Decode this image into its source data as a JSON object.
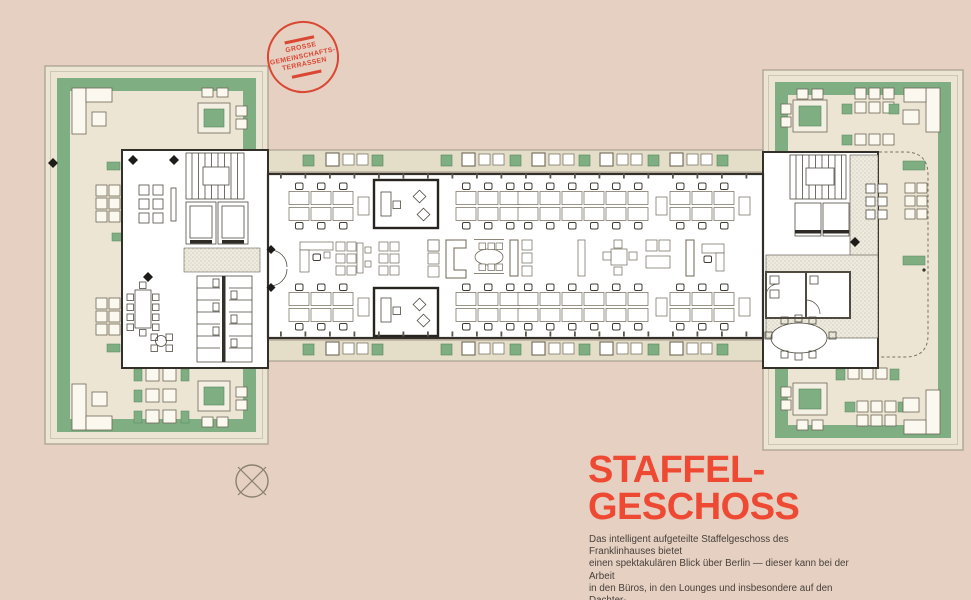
{
  "page": {
    "background_color": "#e6d0c2"
  },
  "stamp": {
    "text": "GROSSE\nGEMEINSCHAFTS-\nTERRASSEN",
    "color": "#da4733"
  },
  "title": {
    "text": "STAFFEL-\nGESCHOSS",
    "color": "#ee4a33"
  },
  "description": {
    "text": "Das intelligent aufgeteilte Staffelgeschoss des Franklinhauses bietet\neinen spektakulären Blick über Berlin — dieser kann bei der Arbeit\nin den Büros, in den Lounges und insbesondere auf den Dachter-\nrassen genossen werden.",
    "color": "#46403a"
  },
  "plan": {
    "colors": {
      "background": "#e6d0c2",
      "wing_terrace": "#ece5d3",
      "balcony_strip": "#e4ddc8",
      "green": "#7fae83",
      "green_dark": "#55855b",
      "wall": "#33302a",
      "furniture_line": "#6f6757",
      "plan_white": "#ffffff",
      "stipple_dot": "#b5ad99"
    },
    "desk_clusters": {
      "xs": [
        322,
        489,
        551,
        617,
        703
      ],
      "top_y": 206,
      "bottom_y": 307
    },
    "balcony": {
      "planter_xs": [
        303,
        372,
        441,
        510,
        579,
        648,
        717
      ],
      "furniture_group_xs": [
        326,
        462,
        532,
        600,
        670
      ],
      "top_planter_y": 155,
      "bottom_planter_y": 344,
      "top_group_y": 153,
      "bottom_group_y": 342
    },
    "middle_items": [
      {
        "type": "corner-desk",
        "x": 300
      },
      {
        "type": "armchair-grid",
        "x": 336
      },
      {
        "type": "high-table",
        "x": 357
      },
      {
        "type": "armchair-grid",
        "x": 379
      },
      {
        "type": "armchair-column",
        "x": 428
      },
      {
        "type": "c-sofa",
        "x": 446
      },
      {
        "type": "oval-table",
        "x": 489
      },
      {
        "type": "sofa-set",
        "x": 510
      },
      {
        "type": "shelf",
        "x": 578
      },
      {
        "type": "table-4",
        "x": 603
      },
      {
        "type": "lounge-pair",
        "x": 646
      },
      {
        "type": "sofa-desk",
        "x": 686
      }
    ],
    "middle_y": 240
  }
}
